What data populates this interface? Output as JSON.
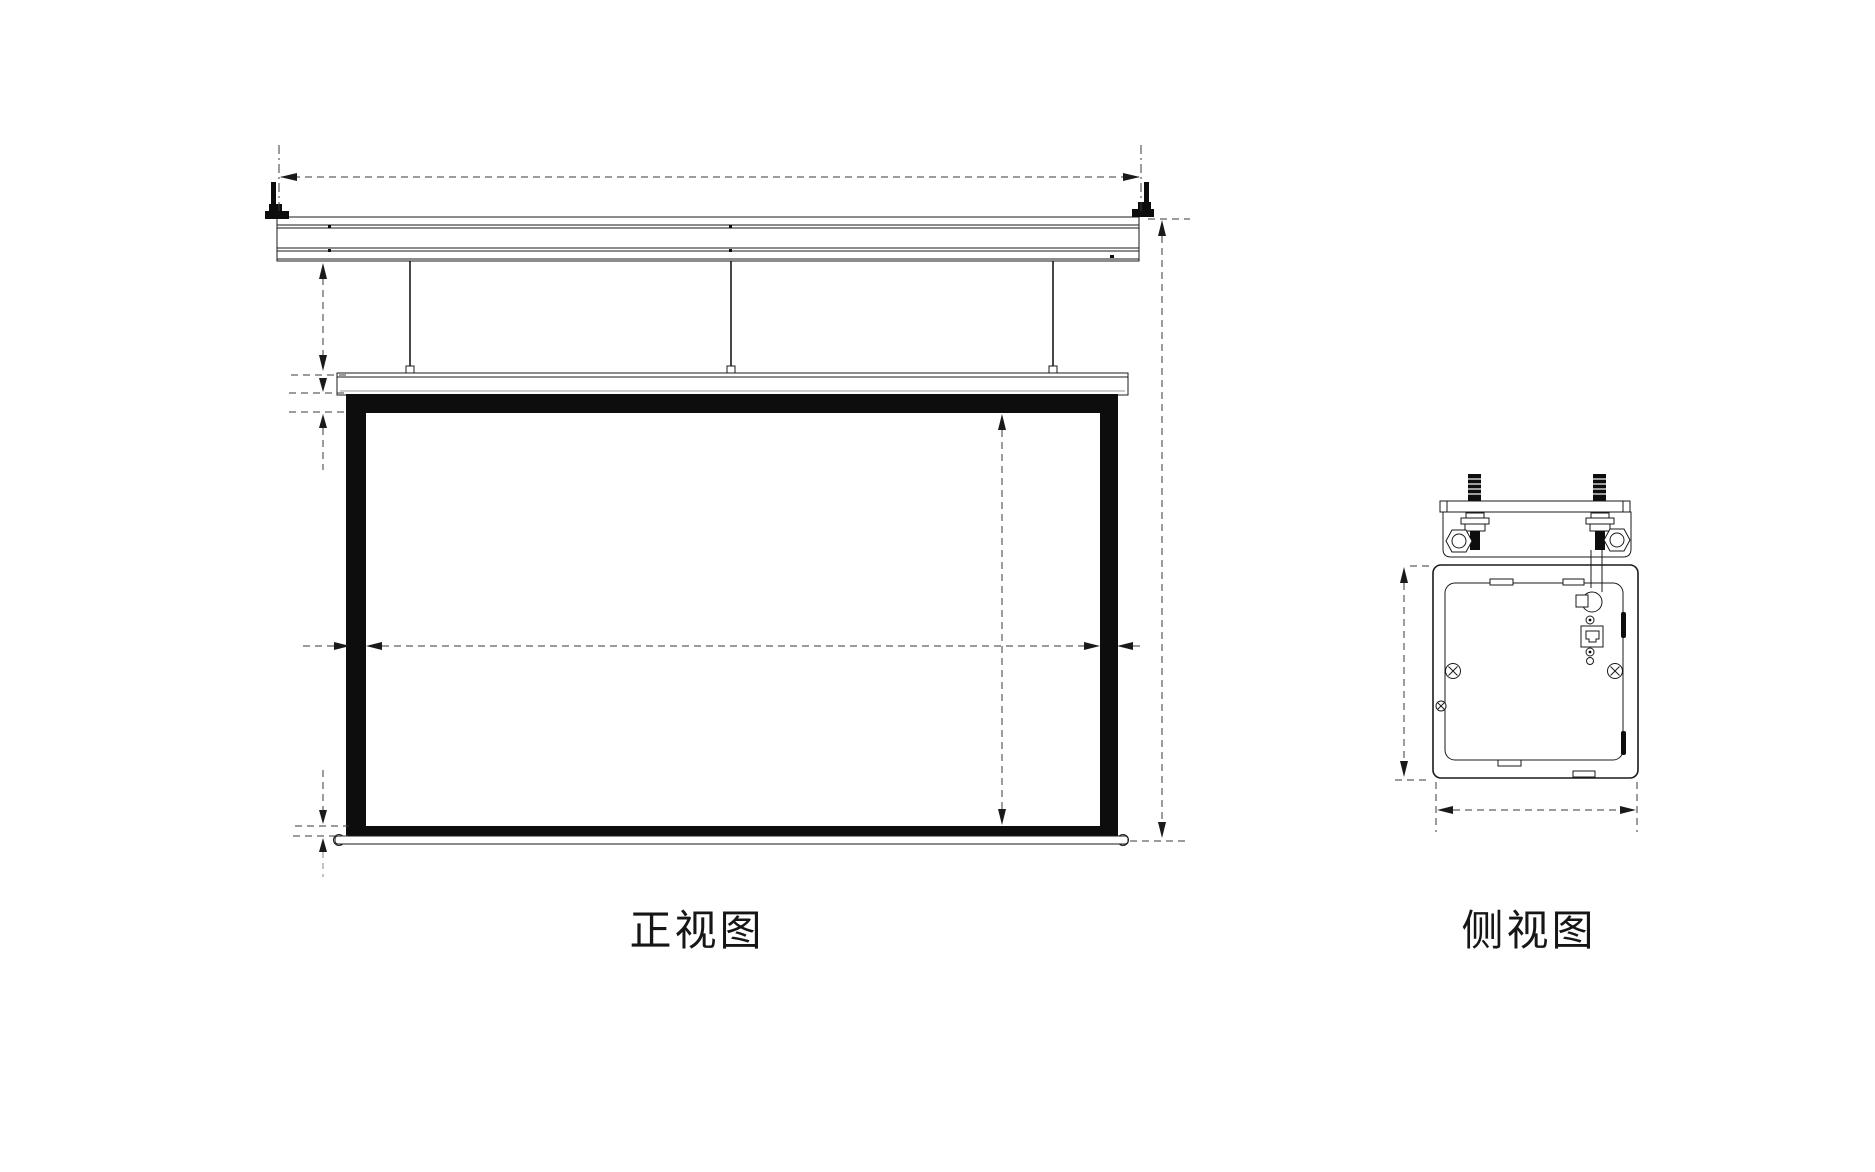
{
  "page": {
    "background": "#ffffff"
  },
  "palette": {
    "line_color": "#1a1a1a",
    "dimension_color": "#3a3a3a",
    "screen_border_fill": "#0d0d0d",
    "paper": "#ffffff"
  },
  "front_view": {
    "label": "正视图"
  },
  "side_view": {
    "label": "侧视图"
  }
}
